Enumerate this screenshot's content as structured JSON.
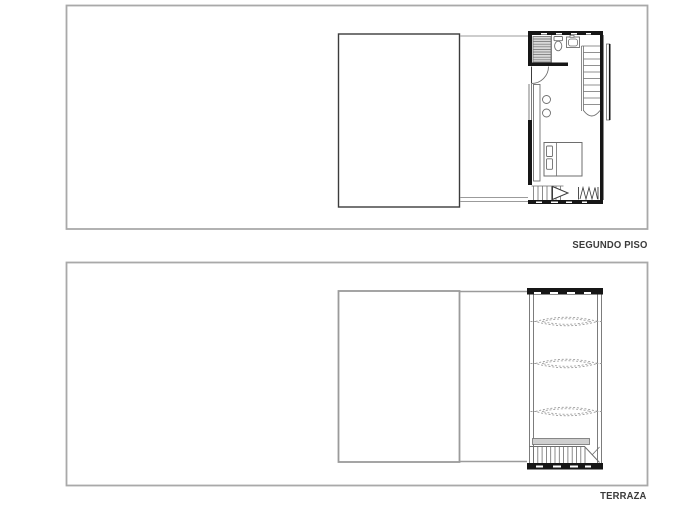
{
  "page": {
    "background": "#ffffff"
  },
  "colors": {
    "frame_border": "#a9a9a9",
    "wall": "#161616",
    "line_dark": "#3c3c3c",
    "line_medium": "#6e6e6e",
    "line_light": "#9b9b9b",
    "stair_fill": "#d8d8d8",
    "bench_fill": "#cfcfcf",
    "label_text": "#3a3a3a"
  },
  "panels": [
    {
      "label": "SEGUNDO PISO"
    },
    {
      "label": "TERRAZA"
    }
  ]
}
